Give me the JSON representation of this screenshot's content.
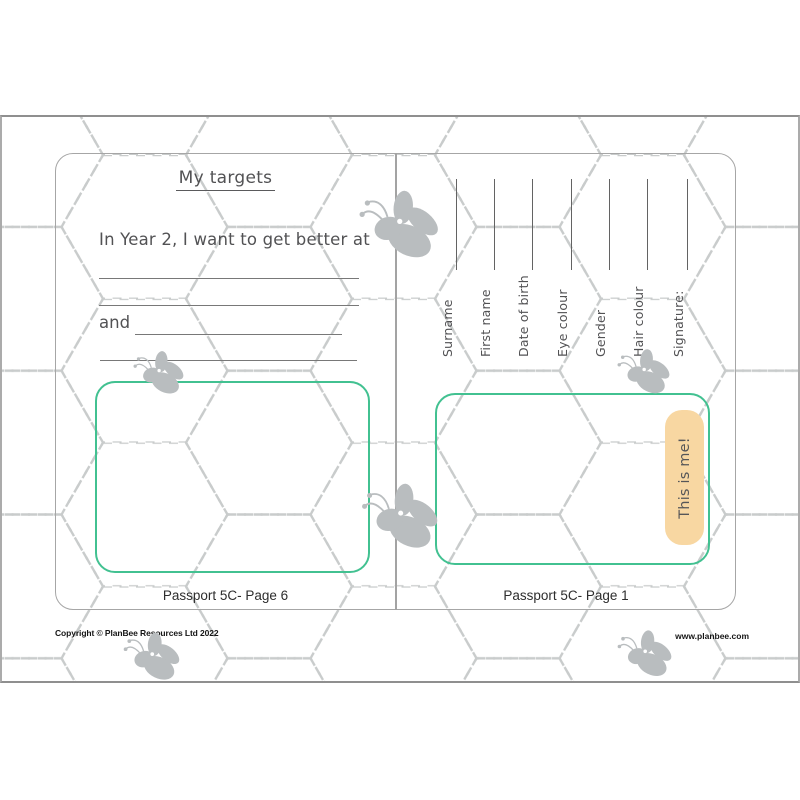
{
  "document": {
    "left_page": {
      "title": "My targets",
      "prompt": "In Year 2, I want to get better at",
      "and_label": "and",
      "caption": "Passport 5C- Page 6"
    },
    "right_page": {
      "fields": [
        {
          "label": "Surname"
        },
        {
          "label": "First name"
        },
        {
          "label": "Date of birth"
        },
        {
          "label": "Eye colour"
        },
        {
          "label": "Gender"
        },
        {
          "label": "Hair colour"
        },
        {
          "label": "Signature:"
        }
      ],
      "photo_label": "This is me!",
      "caption": "Passport 5C- Page 1"
    },
    "footer": {
      "copyright": "Copyright © PlanBee Resources Ltd 2022",
      "website": "www.planbee.com"
    }
  },
  "icons": {
    "bee": "bee-icon",
    "background": "dashed-honeycomb-pattern"
  },
  "colors": {
    "box_green": "#42c191",
    "photo_tab_orange": "#f8d7a2",
    "bee_gray": "#b9bdbf",
    "hex_pattern_gray": "#c9cccc",
    "handwriting_text": "#525254",
    "writing_line_gray": "#787878"
  }
}
